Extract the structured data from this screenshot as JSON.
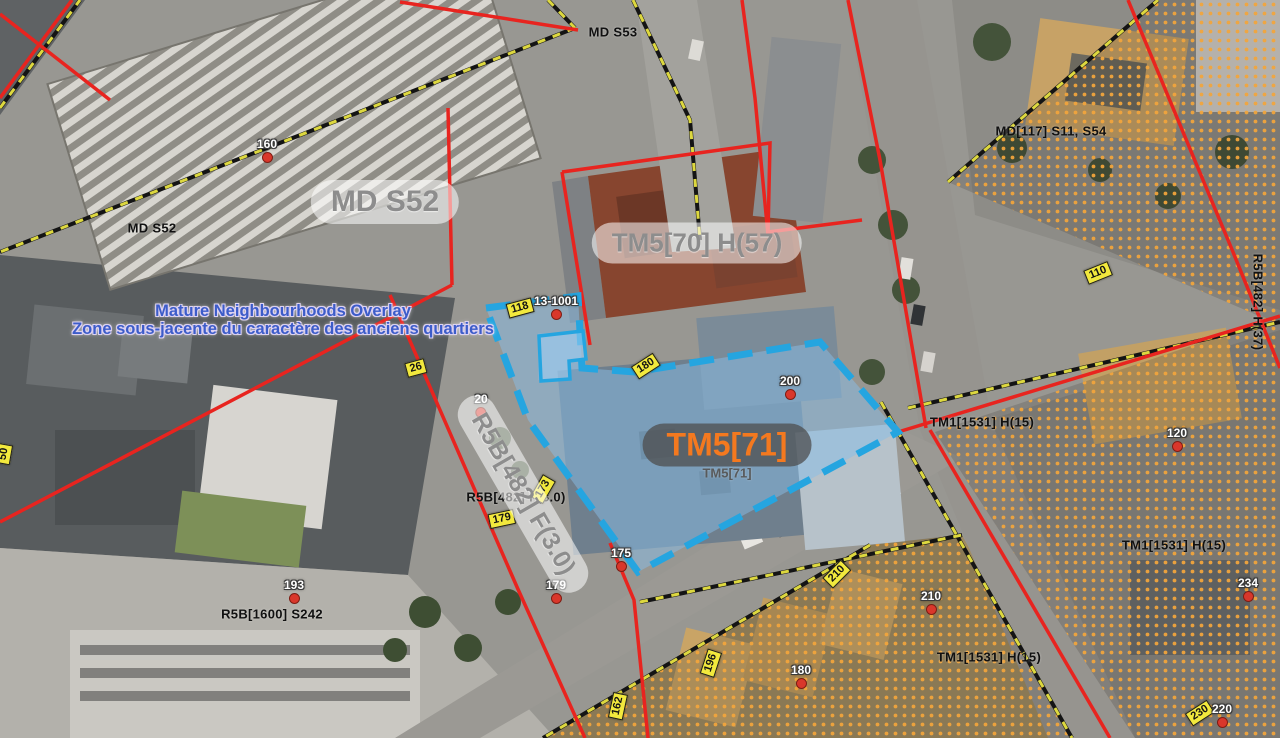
{
  "map_type": "zoning-map-with-aerial-basemap",
  "colors": {
    "zone_boundary_red": "#e8241f",
    "overlay_dash_yellow": "#ddd83f",
    "overlay_dash_black": "#141414",
    "highlight_parcel_outline": "#25a5e0",
    "highlight_parcel_fill": "rgba(135,190,232,0.5)",
    "dotted_overlay_orange": "#f0a43c",
    "address_box_yellow": "#f2e93d",
    "marker_red": "#d9372b",
    "zone_pill_text": "#8d8d8d",
    "highlight_label_orange": "#f4791f",
    "overlay_text_blue": "#3c5cc9"
  },
  "pills": [
    {
      "text": "MD S52",
      "x": 385,
      "y": 202,
      "size": 30,
      "rotation": 0
    },
    {
      "text": "TM5[70] H(57)",
      "x": 697,
      "y": 243,
      "size": 26,
      "rotation": 0
    },
    {
      "text": "R5B[482] F(3.0)",
      "x": 523,
      "y": 494,
      "size": 25,
      "rotation": 60
    }
  ],
  "highlight_label": {
    "text": "TM5[71]",
    "subtext": "TM5[71]"
  },
  "zone_labels": [
    {
      "text": "MD S53",
      "x": 613,
      "y": 32,
      "rotation": 0
    },
    {
      "text": "MD S52",
      "x": 152,
      "y": 228,
      "rotation": 0
    },
    {
      "text": "R5B[482] F(3.0)",
      "x": 516,
      "y": 497,
      "rotation": 0
    },
    {
      "text": "R5B[1600] S242",
      "x": 272,
      "y": 614,
      "rotation": 0
    },
    {
      "text": "TM1[1531] H(15)",
      "x": 982,
      "y": 422,
      "rotation": 0
    },
    {
      "text": "TM1[1531] H(15)",
      "x": 989,
      "y": 657,
      "rotation": 0
    },
    {
      "text": "TM1[1531] H(15)",
      "x": 1174,
      "y": 545,
      "rotation": 0
    },
    {
      "text": "MD[117] S11, S54",
      "x": 1051,
      "y": 131,
      "rotation": 0
    },
    {
      "text": "R5B[482] H(37)",
      "x": 1258,
      "y": 302,
      "rotation": 90
    }
  ],
  "overlay_notice": {
    "line1": "Mature Neighbourhoods Overlay",
    "line2": "Zone sous-jacente du caractère des anciens quartiers"
  },
  "address_points": [
    {
      "text": "160",
      "x": 267,
      "y": 150
    },
    {
      "text": "13-1001",
      "x": 556,
      "y": 307
    },
    {
      "text": "20",
      "x": 481,
      "y": 405
    },
    {
      "text": "200",
      "x": 790,
      "y": 387
    },
    {
      "text": "175",
      "x": 621,
      "y": 559
    },
    {
      "text": "179",
      "x": 556,
      "y": 591
    },
    {
      "text": "193",
      "x": 294,
      "y": 591
    },
    {
      "text": "120",
      "x": 1177,
      "y": 439
    },
    {
      "text": "210",
      "x": 931,
      "y": 602
    },
    {
      "text": "234",
      "x": 1248,
      "y": 589
    },
    {
      "text": "180",
      "x": 801,
      "y": 676
    },
    {
      "text": "220",
      "x": 1222,
      "y": 715
    }
  ],
  "address_boxes": [
    {
      "text": "118",
      "x": 520,
      "y": 308,
      "rotation": -15
    },
    {
      "text": "26",
      "x": 416,
      "y": 368,
      "rotation": -15
    },
    {
      "text": "180",
      "x": 646,
      "y": 366,
      "rotation": -33
    },
    {
      "text": "173",
      "x": 543,
      "y": 489,
      "rotation": -60
    },
    {
      "text": "179",
      "x": 502,
      "y": 519,
      "rotation": -12
    },
    {
      "text": "110",
      "x": 1098,
      "y": 273,
      "rotation": -22
    },
    {
      "text": "210",
      "x": 837,
      "y": 574,
      "rotation": -45
    },
    {
      "text": "162",
      "x": 618,
      "y": 706,
      "rotation": -78
    },
    {
      "text": "196",
      "x": 711,
      "y": 663,
      "rotation": -72
    },
    {
      "text": "230",
      "x": 1200,
      "y": 713,
      "rotation": -33
    },
    {
      "text": "50",
      "x": 4,
      "y": 454,
      "rotation": -80
    }
  ]
}
